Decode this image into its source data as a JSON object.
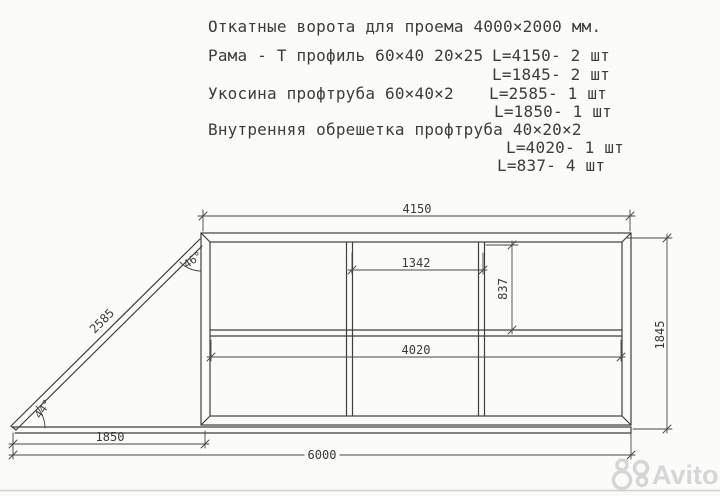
{
  "title_block": {
    "lines": [
      "Откатные ворота для проема 4000×2000 мм.",
      "Рама - Т профиль 60×40 20×25",
      "L=4150- 2 шт",
      "L=1845- 2 шт",
      "Укосина профтруба 60×40×2",
      "L=2585- 1 шт",
      "L=1850- 1 шт",
      "Внутренняя обрешетка профтруба 40×20×2",
      "L=4020- 1 шт",
      "L=837- 4 шт"
    ]
  },
  "dims": {
    "frame_width": "4150",
    "lattice_top": "1342",
    "lattice_height": "837",
    "lattice_width": "4020",
    "frame_height": "1845",
    "brace_length": "2585",
    "counterweight_base": "1850",
    "total_length": "6000",
    "angle_top": "46°",
    "angle_bottom": "44°"
  },
  "watermark": {
    "text": "Avito"
  },
  "colors": {
    "ink": "#3f3f3f",
    "paper": "#fbfbf9",
    "watermark": "#d6d6d6"
  }
}
